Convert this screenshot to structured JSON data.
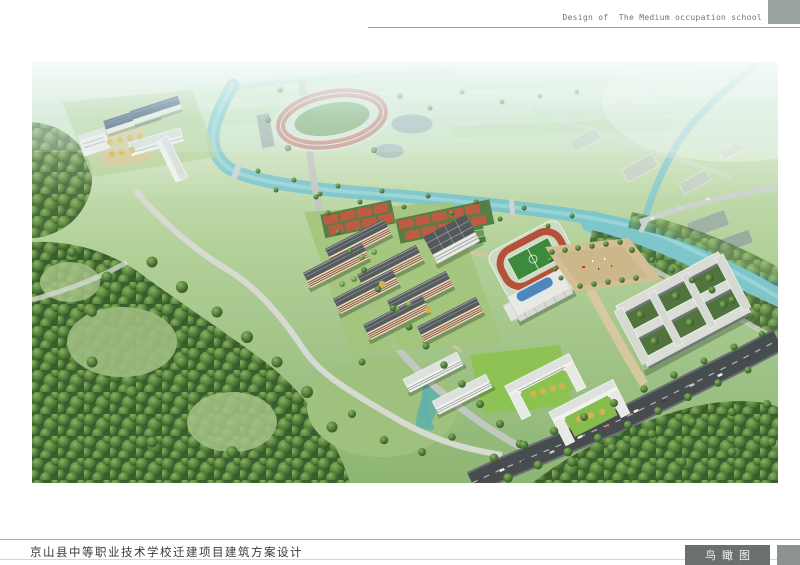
{
  "header": {
    "title": "Design of  The Medium occupation school"
  },
  "footer": {
    "project_title": "京山县中等职业技术学校迁建项目建筑方案设计",
    "drawing_label": "鸟瞰图"
  },
  "palette": {
    "header_block": "#9aa2a0",
    "footer_label_bg": "#6b6f6f",
    "water": "#7ec6ca",
    "track_red": "#b5503a",
    "pitch_green": "#3e8a3c",
    "roof_navy": "#2c4668",
    "roof_blue": "#4f86bc",
    "facade_cream": "#e7ddc1",
    "road_dark": "#474c4f",
    "forest_green": "#3a5e2e"
  }
}
